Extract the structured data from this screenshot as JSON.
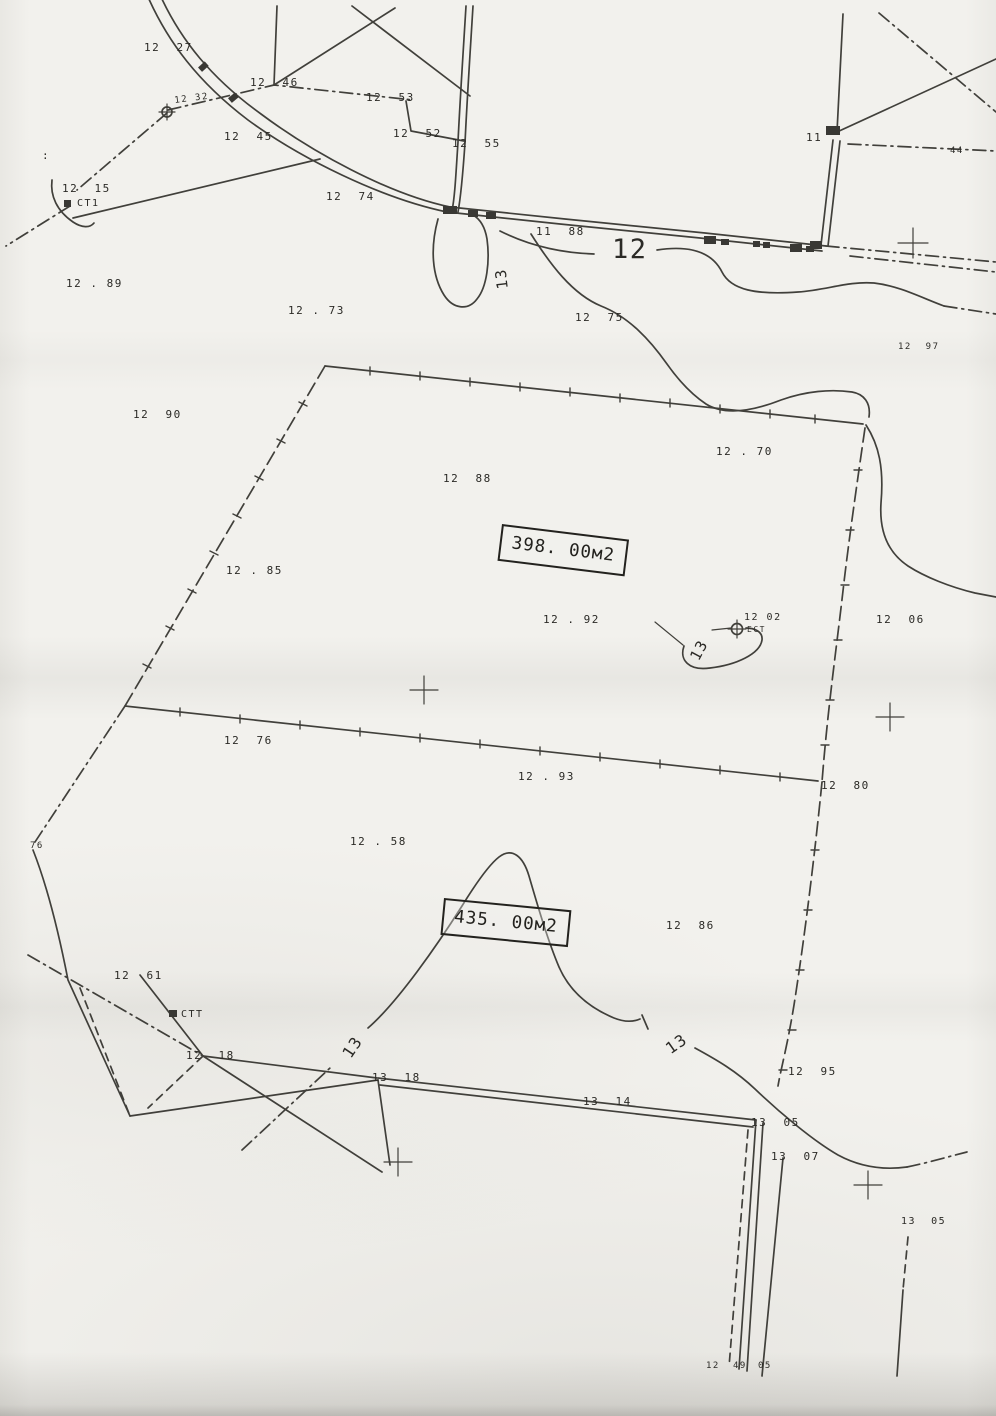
{
  "paper_color": "#f2f1ed",
  "ink_color": "#34332e",
  "areas": {
    "upper": "398. 00м2",
    "lower": "435. 00м2"
  },
  "symbols": {
    "benchmark_icon": "⊕",
    "grid_cross_icon": "+",
    "station_square_icon": "▪"
  },
  "contour_values": [
    "12",
    "13"
  ],
  "labels": [
    {
      "text": "12  27",
      "x": 144,
      "y": 42
    },
    {
      "text": "12  46",
      "x": 250,
      "y": 77
    },
    {
      "text": "12  53",
      "x": 366,
      "y": 92
    },
    {
      "text": "12  52",
      "x": 393,
      "y": 128
    },
    {
      "text": "12  55",
      "x": 452,
      "y": 138
    },
    {
      "text": "12  45",
      "x": 224,
      "y": 131
    },
    {
      "text": "12 32",
      "x": 174,
      "y": 97,
      "rot": -7,
      "size": 9
    },
    {
      "text": "12  15",
      "x": 62,
      "y": 183
    },
    {
      "text": "СТ1",
      "x": 77,
      "y": 199,
      "size": 10,
      "name": "station-label"
    },
    {
      "text": "11",
      "x": 806,
      "y": 132
    },
    {
      "text": "44",
      "x": 950,
      "y": 147,
      "size": 9
    },
    {
      "text": "12  74",
      "x": 326,
      "y": 191
    },
    {
      "text": "11  88",
      "x": 536,
      "y": 226
    },
    {
      "text": "12",
      "x": 612,
      "y": 236,
      "size": 27,
      "name": "contour-label-12"
    },
    {
      "text": "13",
      "x": 496,
      "y": 290,
      "rot": -97,
      "size": 15,
      "name": "contour-label-13"
    },
    {
      "text": "12 . 89",
      "x": 66,
      "y": 278
    },
    {
      "text": "12 . 73",
      "x": 288,
      "y": 305
    },
    {
      "text": "12  75",
      "x": 575,
      "y": 312
    },
    {
      "text": "12  97",
      "x": 898,
      "y": 343,
      "size": 9
    },
    {
      "text": "12  90",
      "x": 133,
      "y": 409
    },
    {
      "text": "12 . 70",
      "x": 716,
      "y": 446
    },
    {
      "text": "12  88",
      "x": 443,
      "y": 473
    },
    {
      "text": "12 . 85",
      "x": 226,
      "y": 565
    },
    {
      "text": "12 . 92",
      "x": 543,
      "y": 614
    },
    {
      "text": "12 02",
      "x": 744,
      "y": 613,
      "size": 10
    },
    {
      "text": "ЕСТ",
      "x": 747,
      "y": 626,
      "size": 8,
      "name": "benchmark-label"
    },
    {
      "text": "13",
      "x": 688,
      "y": 656,
      "rot": -62,
      "size": 15,
      "name": "contour-label-13"
    },
    {
      "text": "12  06",
      "x": 876,
      "y": 614
    },
    {
      "text": "12  76",
      "x": 224,
      "y": 735
    },
    {
      "text": "12 . 93",
      "x": 518,
      "y": 771
    },
    {
      "text": "12  80",
      "x": 821,
      "y": 780
    },
    {
      "text": "12 . 58",
      "x": 350,
      "y": 836
    },
    {
      "text": "76",
      "x": 30,
      "y": 842,
      "size": 9
    },
    {
      "text": "12  86",
      "x": 666,
      "y": 920
    },
    {
      "text": "12  61",
      "x": 114,
      "y": 970
    },
    {
      "text": "СТТ",
      "x": 181,
      "y": 1010,
      "size": 10,
      "name": "station-label"
    },
    {
      "text": "12  18",
      "x": 186,
      "y": 1050
    },
    {
      "text": "13  18",
      "x": 372,
      "y": 1072
    },
    {
      "text": "13",
      "x": 340,
      "y": 1052,
      "rot": -56,
      "size": 16,
      "name": "contour-label-13"
    },
    {
      "text": "13",
      "x": 663,
      "y": 1044,
      "rot": -35,
      "size": 16,
      "name": "contour-label-13"
    },
    {
      "text": "13  14",
      "x": 583,
      "y": 1096
    },
    {
      "text": "12  95",
      "x": 788,
      "y": 1066
    },
    {
      "text": "13  05",
      "x": 751,
      "y": 1117
    },
    {
      "text": "13  07",
      "x": 771,
      "y": 1151
    },
    {
      "text": "13  05",
      "x": 901,
      "y": 1217,
      "size": 10
    },
    {
      "text": "12",
      "x": 706,
      "y": 1362,
      "size": 9
    },
    {
      "text": "49",
      "x": 733,
      "y": 1362,
      "size": 9
    },
    {
      "text": "05",
      "x": 758,
      "y": 1362,
      "size": 9
    },
    {
      "text": ":",
      "x": 42,
      "y": 150
    }
  ]
}
